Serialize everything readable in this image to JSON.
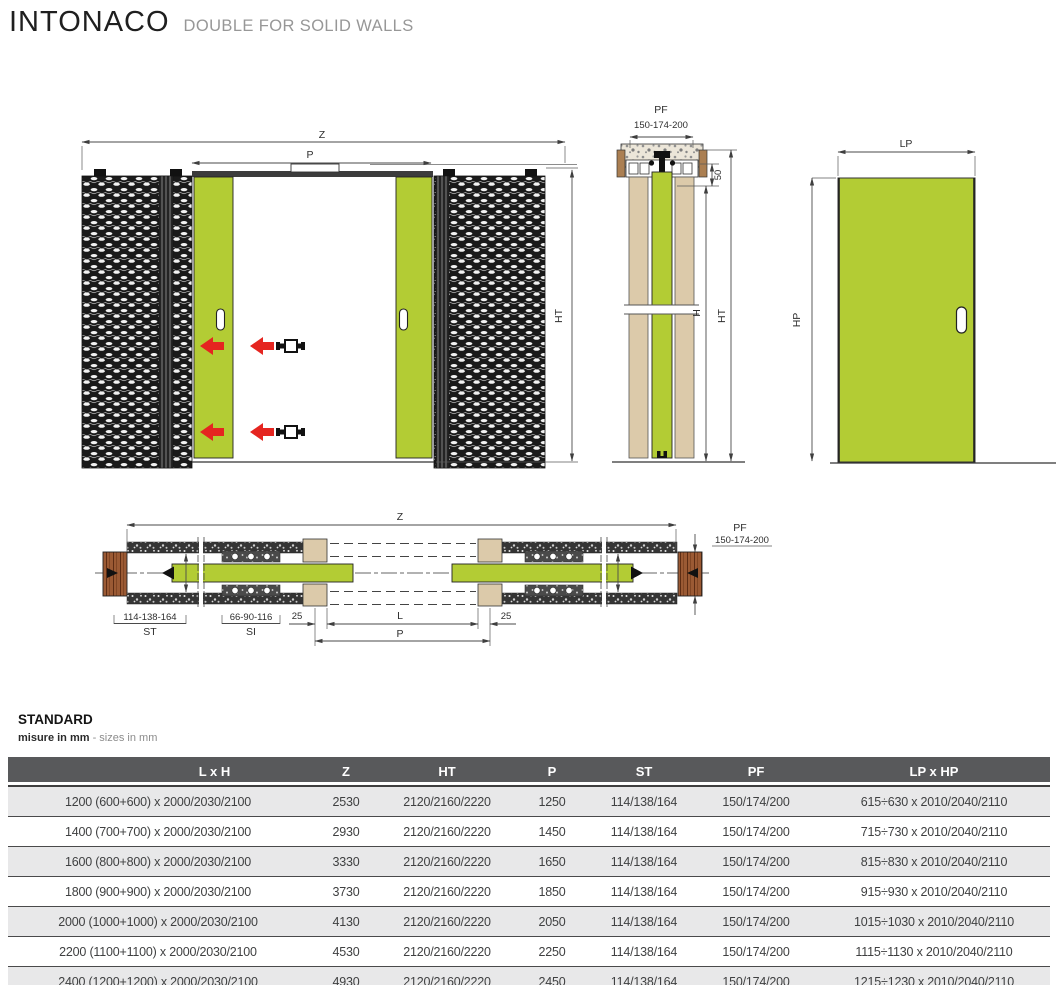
{
  "header": {
    "title": "INTONACO",
    "subtitle": "DOUBLE FOR SOLID WALLS"
  },
  "front_view": {
    "dim_z": "Z",
    "dim_p": "P",
    "dim_ht": "HT"
  },
  "section_view": {
    "dim_pf": "PF",
    "dim_pf_values": "150-174-200",
    "dim_50": "50",
    "dim_h": "H",
    "dim_ht": "HT"
  },
  "panel_view": {
    "dim_lp": "LP",
    "dim_hp": "HP"
  },
  "plan_view": {
    "dim_z": "Z",
    "dim_pf": "PF",
    "dim_pf_values": "150-174-200",
    "dim_st_values": "114-138-164",
    "dim_st": "ST",
    "dim_si_values": "66-90-116",
    "dim_si": "SI",
    "dim_25_left": "25",
    "dim_25_right": "25",
    "dim_l": "L",
    "dim_p": "P"
  },
  "table": {
    "title": "STANDARD",
    "note_bold": "misure in mm",
    "note_light": " - sizes in mm",
    "columns": [
      "L x H",
      "Z",
      "HT",
      "P",
      "ST",
      "PF",
      "LP x HP"
    ],
    "rows": [
      [
        "1200 (600+600) x 2000/2030/2100",
        "2530",
        "2120/2160/2220",
        "1250",
        "114/138/164",
        "150/174/200",
        "615÷630 x 2010/2040/2110"
      ],
      [
        "1400 (700+700) x 2000/2030/2100",
        "2930",
        "2120/2160/2220",
        "1450",
        "114/138/164",
        "150/174/200",
        "715÷730 x 2010/2040/2110"
      ],
      [
        "1600 (800+800) x 2000/2030/2100",
        "3330",
        "2120/2160/2220",
        "1650",
        "114/138/164",
        "150/174/200",
        "815÷830 x 2010/2040/2110"
      ],
      [
        "1800 (900+900) x 2000/2030/2100",
        "3730",
        "2120/2160/2220",
        "1850",
        "114/138/164",
        "150/174/200",
        "915÷930 x 2010/2040/2110"
      ],
      [
        "2000 (1000+1000) x 2000/2030/2100",
        "4130",
        "2120/2160/2220",
        "2050",
        "114/138/164",
        "150/174/200",
        "1015÷1030 x 2010/2040/2110"
      ],
      [
        "2200 (1100+1100) x 2000/2030/2100",
        "4530",
        "2120/2160/2220",
        "2250",
        "114/138/164",
        "150/174/200",
        "1115÷1130 x 2010/2040/2110"
      ],
      [
        "2400 (1200+1200) x 2000/2030/2100",
        "4930",
        "2120/2160/2220",
        "2450",
        "114/138/164",
        "150/174/200",
        "1215÷1230 x 2010/2040/2110"
      ]
    ]
  },
  "colors": {
    "accent_green": "#b3cc34",
    "arrow_red": "#e52520",
    "header_gray": "#58595b"
  }
}
